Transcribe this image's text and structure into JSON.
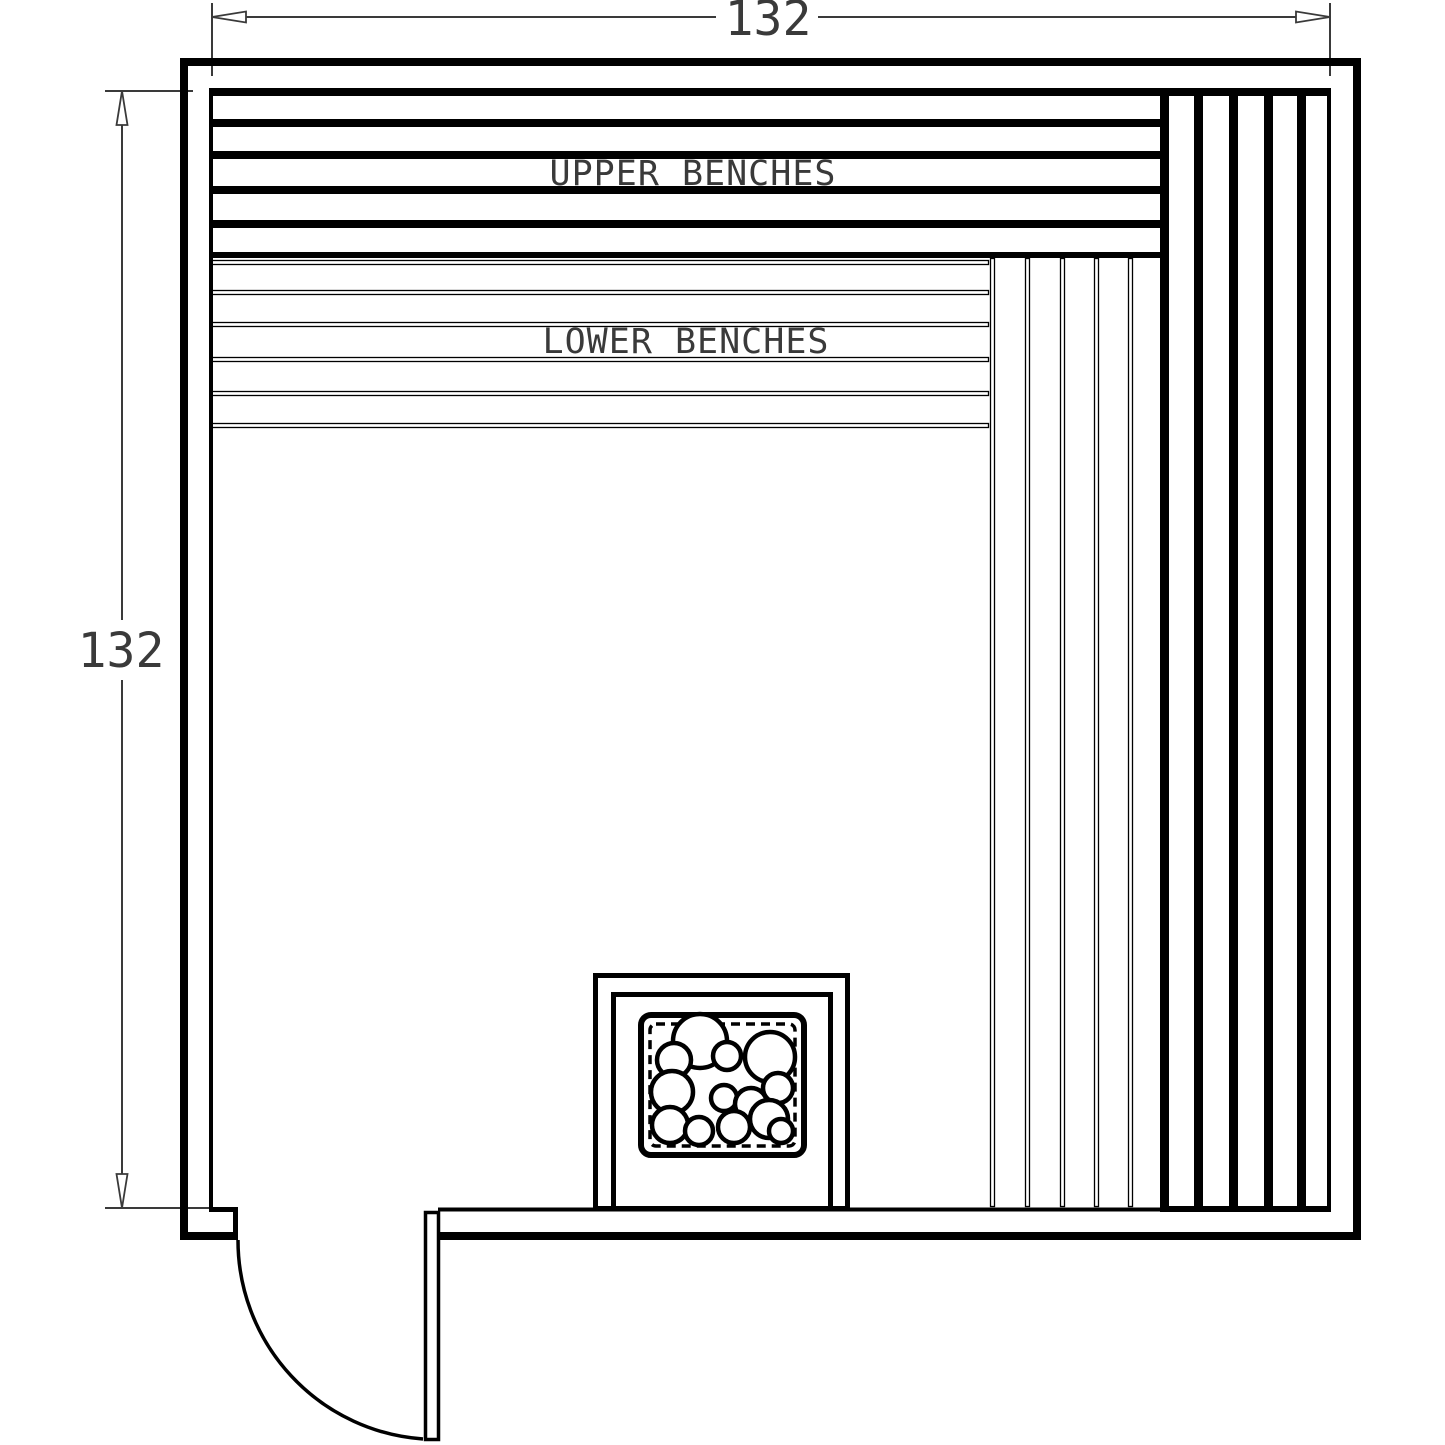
{
  "drawing": {
    "type": "sauna-floor-plan",
    "labels": {
      "upper_benches": "UPPER BENCHES",
      "lower_benches": "LOWER BENCHES"
    },
    "dimensions": {
      "width": "132",
      "height": "132"
    },
    "colors": {
      "line": "#000000",
      "dim_line": "#3a3a3a",
      "text": "#3a3a3a",
      "background": "#ffffff"
    },
    "upper_bench_bands": [
      {
        "y": 88,
        "h": 8
      },
      {
        "y": 119,
        "h": 8
      },
      {
        "y": 151,
        "h": 8
      },
      {
        "y": 186,
        "h": 8
      },
      {
        "y": 220,
        "h": 8
      },
      {
        "y": 252,
        "h": 6
      }
    ],
    "lower_bench_boards_y": [
      260,
      290,
      322,
      357,
      391,
      423
    ],
    "side_bench_lines_x": [
      990,
      1025,
      1060,
      1094,
      1128
    ],
    "wall_plank_dividers_x": [
      1194,
      1229,
      1264,
      1297
    ],
    "heater_rocks": [
      {
        "cx": 700,
        "cy": 1041,
        "r": 27
      },
      {
        "cx": 674,
        "cy": 1060,
        "r": 17
      },
      {
        "cx": 727,
        "cy": 1056,
        "r": 14
      },
      {
        "cx": 770,
        "cy": 1057,
        "r": 25
      },
      {
        "cx": 672,
        "cy": 1092,
        "r": 21
      },
      {
        "cx": 778,
        "cy": 1088,
        "r": 15
      },
      {
        "cx": 724,
        "cy": 1098,
        "r": 13
      },
      {
        "cx": 751,
        "cy": 1104,
        "r": 16
      },
      {
        "cx": 670,
        "cy": 1125,
        "r": 18
      },
      {
        "cx": 699,
        "cy": 1131,
        "r": 14
      },
      {
        "cx": 734,
        "cy": 1127,
        "r": 16
      },
      {
        "cx": 769,
        "cy": 1119,
        "r": 19
      },
      {
        "cx": 781,
        "cy": 1131,
        "r": 12
      }
    ]
  }
}
